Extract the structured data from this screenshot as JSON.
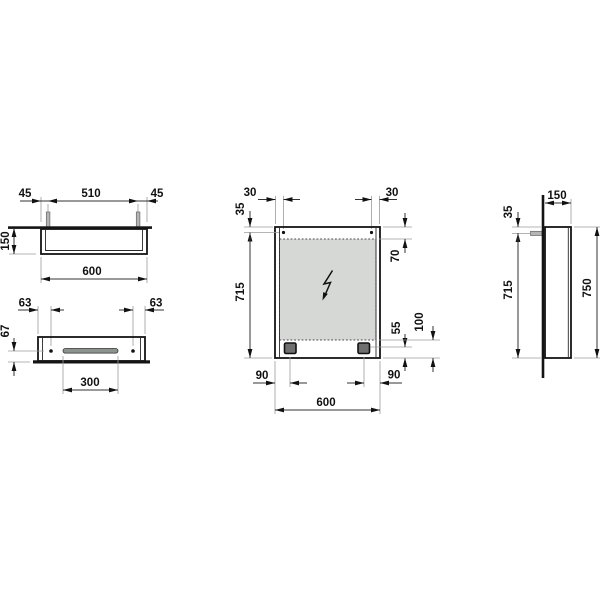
{
  "drawing_type": "mirror-cabinet-technical-drawing",
  "colors": {
    "line": "#141414",
    "dim_line": "#333333",
    "ext_line": "#9b9b9b",
    "mirror_fill": "#d5d8d5",
    "metal_fill": "#b5b5b5",
    "light_fill": "#6f6f6f",
    "slot_fill": "#8d938d",
    "background": "#ffffff"
  },
  "views": {
    "top": {
      "offset_left": "45",
      "hanger_span": "510",
      "offset_right": "45",
      "depth": "150",
      "width": "600"
    },
    "bottom": {
      "hole_offset_left": "63",
      "hole_offset_right": "63",
      "hole_depth": "67",
      "slot_width": "300"
    },
    "front": {
      "hanger_offset_left": "30",
      "hanger_offset_right": "30",
      "hanger_from_top": "35",
      "mirror_from_top": "70",
      "mounting_height": "715",
      "light_from_bottom": "55",
      "mirror_from_bottom": "100",
      "light_offset_left": "90",
      "light_offset_right": "90",
      "width": "600"
    },
    "side": {
      "depth": "150",
      "hanger_from_top": "35",
      "mounting_height": "715",
      "height": "750"
    }
  },
  "icons": {
    "power_symbol": "lightning-bolt"
  }
}
